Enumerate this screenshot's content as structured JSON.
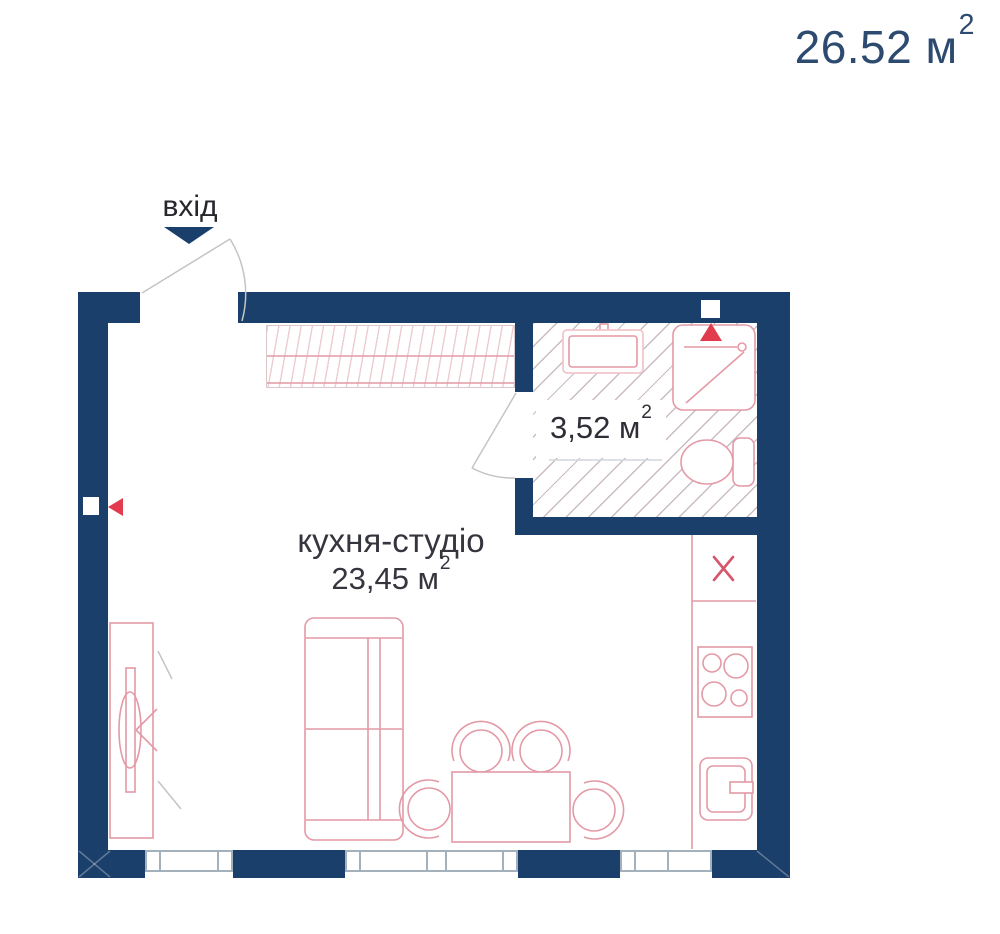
{
  "labels": {
    "total_area_value": "26.52 м",
    "sup2": "2",
    "entrance": "вхід",
    "room_name": "кухня-студіо",
    "room_area_value": "23,45 м",
    "bathroom_area_value": "3,52 м"
  },
  "rooms": [
    {
      "name": "кухня-студіо",
      "area_m2": "23,45"
    },
    {
      "name": "санвузол",
      "area_m2": "3,52"
    }
  ],
  "total_area_m2": "26.52",
  "icons": {
    "entrance_arrow": "triangle-down",
    "vent_marker_top": "triangle-up",
    "vent_marker_left": "triangle-left",
    "blocked_cell_marker": "x-cross"
  },
  "colors": {
    "wall": "#1b3f6b",
    "accent_red": "#e23b4e",
    "furniture_outline": "#e39aa6",
    "furniture_pale": "#f2c6cc",
    "title_text": "#2d4b70",
    "label_text": "#35353e",
    "hatch": "#a98fa0",
    "window_line": "#a3b1bd",
    "door_line": "#c4c4c4"
  }
}
